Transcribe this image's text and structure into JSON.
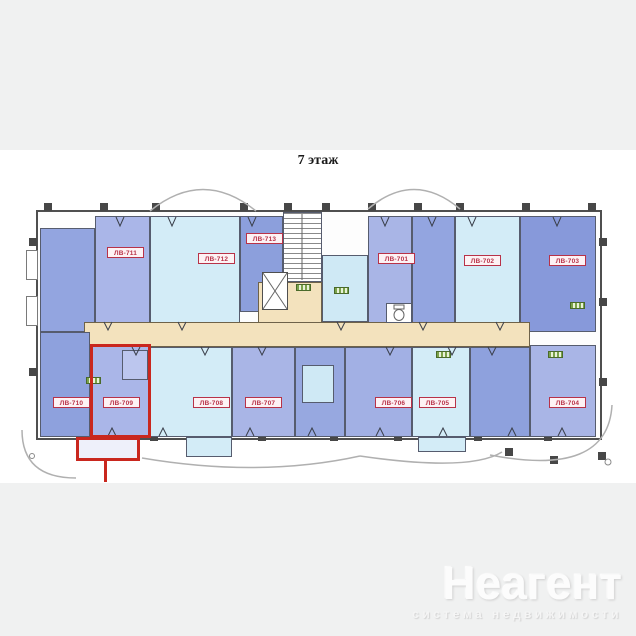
{
  "title": "7 этаж",
  "plan": {
    "highlighted_unit": "ЛВ-709",
    "colors": {
      "highlight": "#c9271e",
      "corridor": "#f3e2bd",
      "room_blue": "#8ea1dd",
      "room_periwinkle": "#aab6e8",
      "room_cyan": "#d3ecf7",
      "unit_label": "#b83248",
      "wall": "#4f4f4f",
      "page_background": "#f0f1f1"
    },
    "units": [
      {
        "label": "ЛВ-711"
      },
      {
        "label": "ЛВ-712"
      },
      {
        "label": "ЛВ-713"
      },
      {
        "label": "ЛВ-701"
      },
      {
        "label": "ЛВ-702"
      },
      {
        "label": "ЛВ-703"
      },
      {
        "label": "ЛВ-710"
      },
      {
        "label": "ЛВ-709"
      },
      {
        "label": "ЛВ-708"
      },
      {
        "label": "ЛВ-707"
      },
      {
        "label": "ЛВ-706"
      },
      {
        "label": "ЛВ-705"
      },
      {
        "label": "ЛВ-704"
      }
    ]
  },
  "watermark": {
    "brand": "Неагент",
    "tagline": "система недвижимости"
  }
}
